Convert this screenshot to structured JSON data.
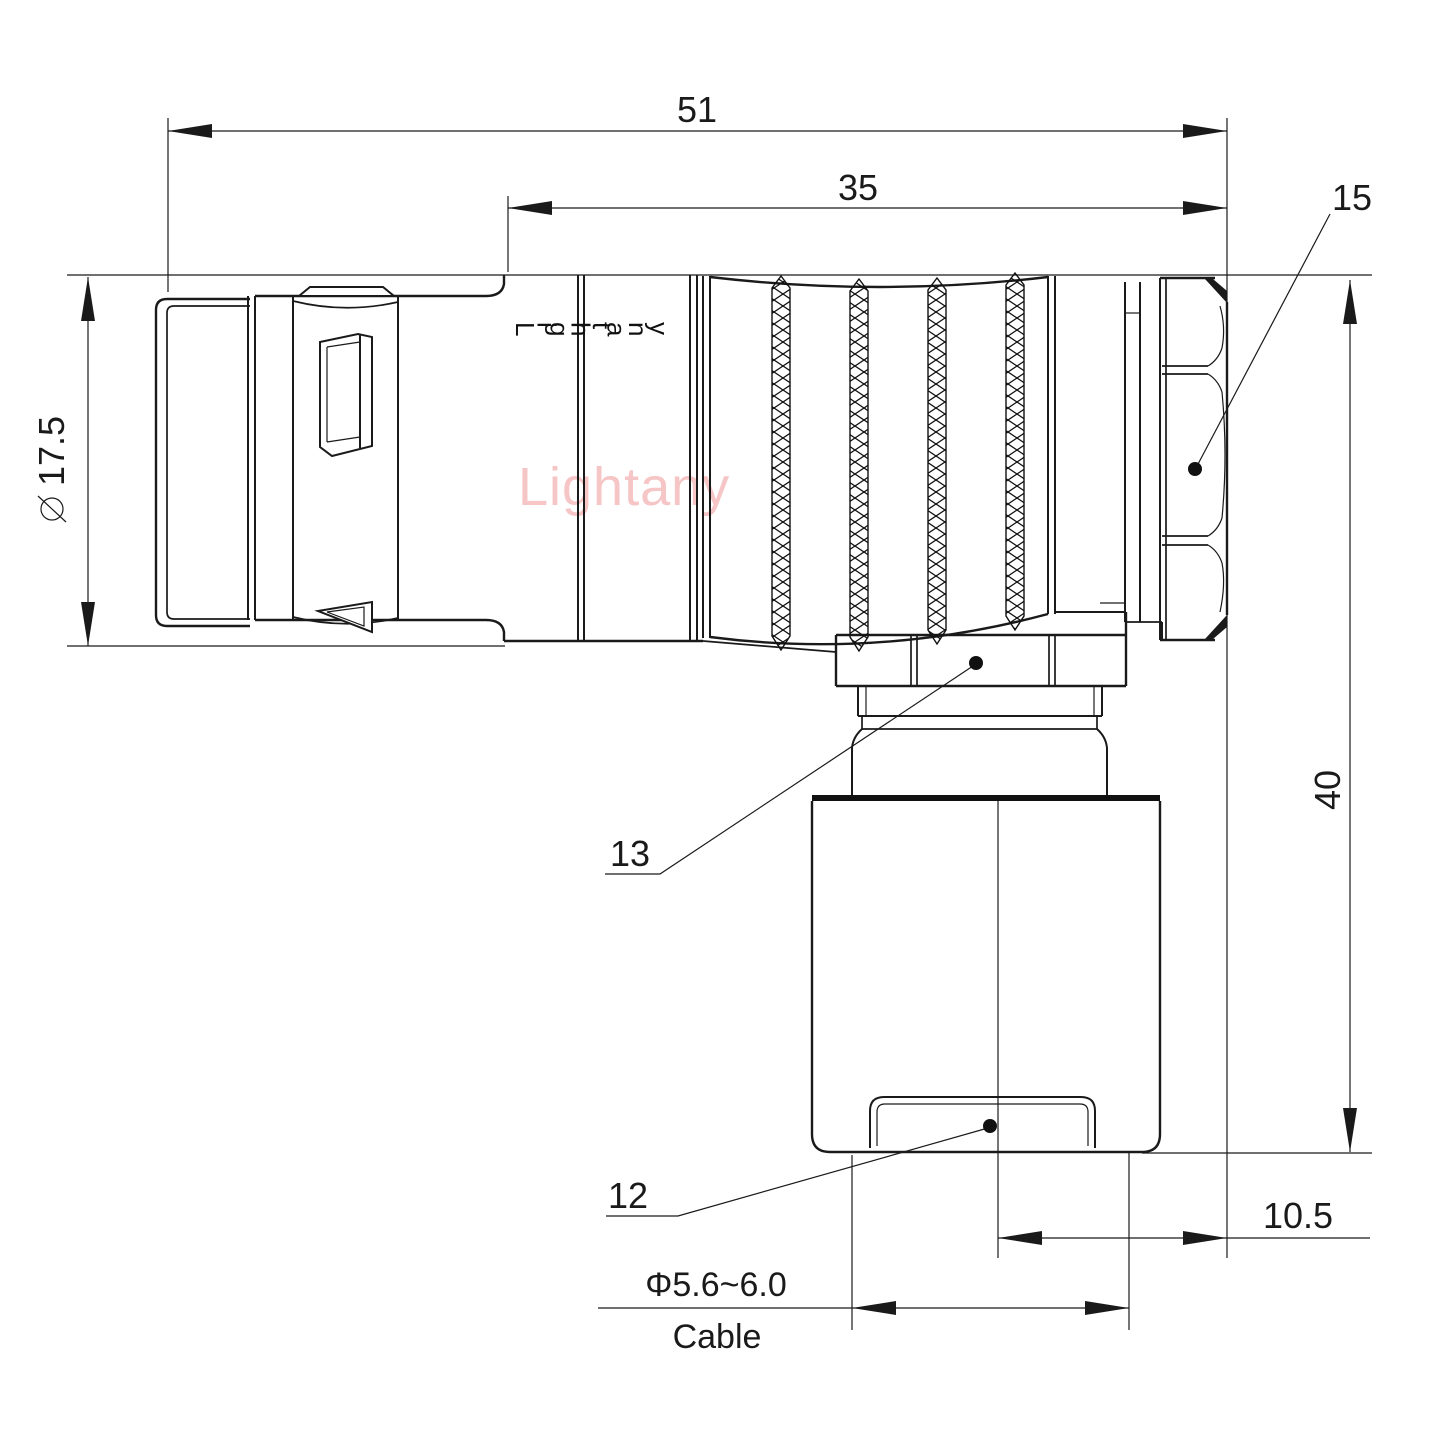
{
  "drawing": {
    "watermark": "Lightany",
    "brand_engraving": "Lightany",
    "background_color": "#ffffff",
    "line_color": "#1a1a1a",
    "watermark_color": "#f6c5c5",
    "dimensions": {
      "overall_length": {
        "value": "51"
      },
      "rear_section_length": {
        "value": "35"
      },
      "front_diameter": {
        "symbol": "⌀",
        "value": "17.5"
      },
      "height": {
        "value": "40"
      },
      "axis_to_back_face": {
        "value": "10.5"
      },
      "cable_diameter": {
        "value": "Φ5.6~6.0"
      },
      "cable_word": {
        "value": "Cable"
      }
    },
    "part_labels": {
      "back_nut": "15",
      "coupling_nut": "13",
      "cable_clamp": "12"
    }
  }
}
